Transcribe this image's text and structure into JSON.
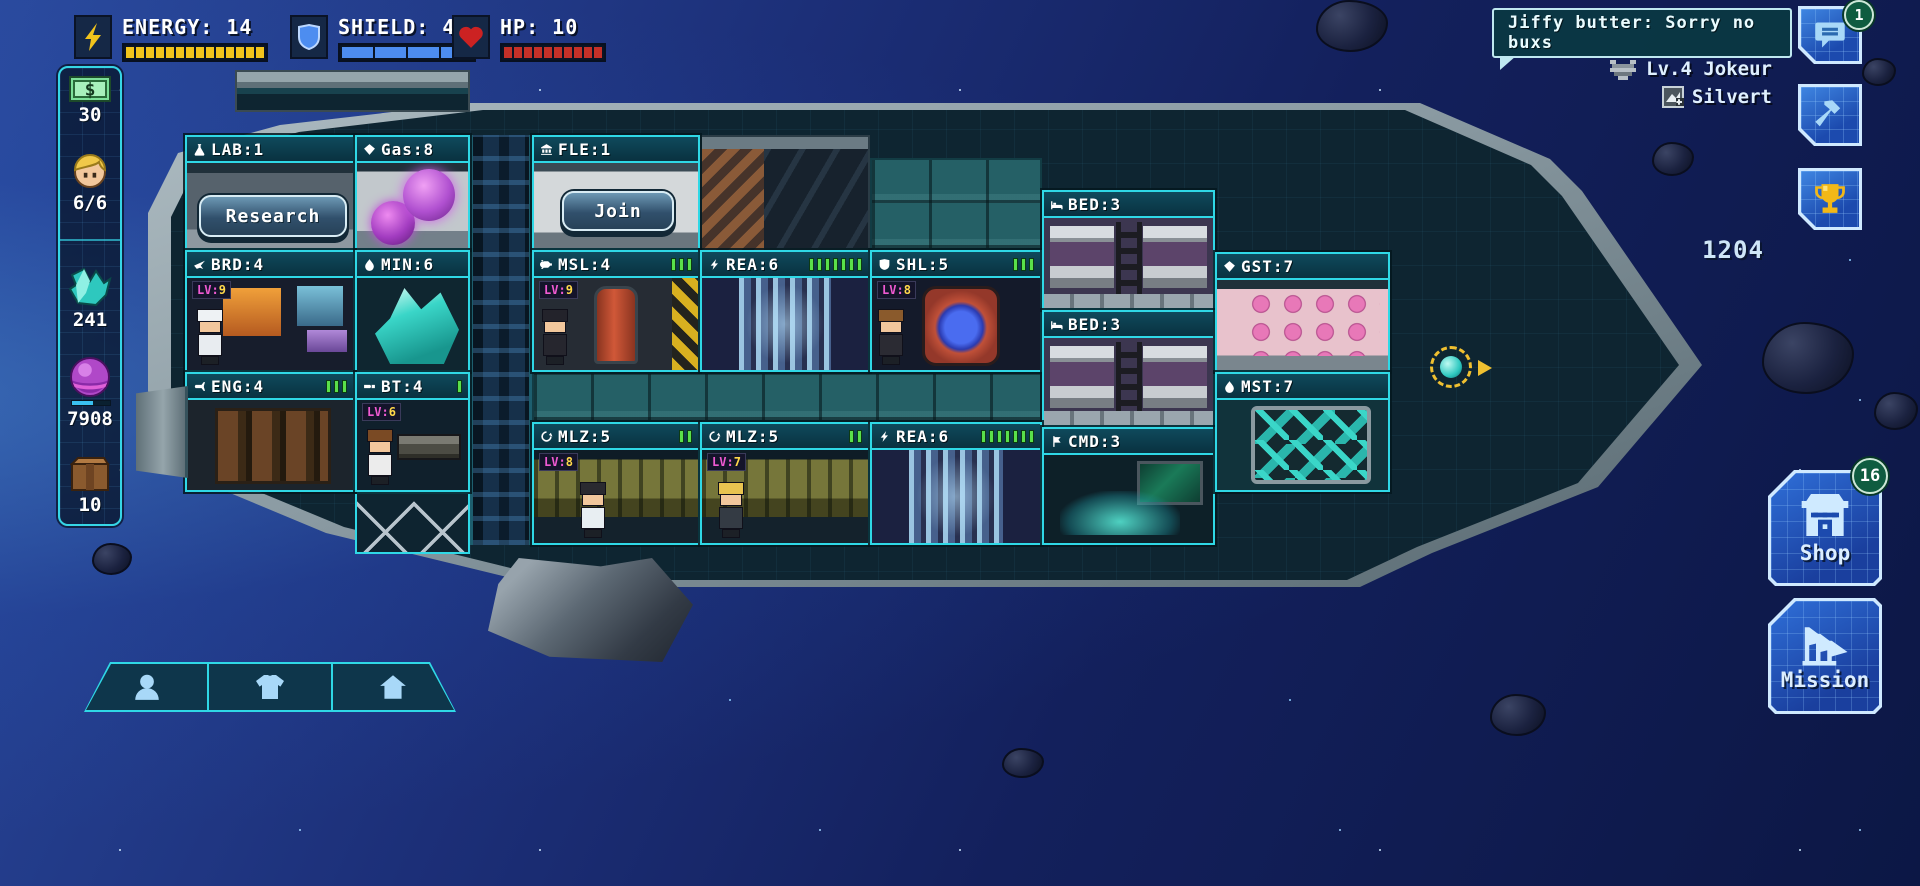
{
  "status_bar": {
    "energy_label": "ENERGY: 14",
    "energy_value": 14,
    "energy_max": 14,
    "shield_label": "SHIELD: 4",
    "shield_value": 4,
    "shield_max": 4,
    "hp_label": "HP: 10",
    "hp_value": 10,
    "hp_max": 10
  },
  "sidebar": {
    "items": [
      {
        "icon": "cash-icon",
        "value": "30"
      },
      {
        "icon": "crew-icon",
        "value": "6/6"
      },
      {
        "icon": "mineral-icon",
        "value": "241"
      },
      {
        "icon": "gas-orb-icon",
        "value": "7908"
      },
      {
        "icon": "crate-icon",
        "value": "10"
      }
    ]
  },
  "chat": {
    "message": "Jiffy butter: Sorry no buxs",
    "badge": "1"
  },
  "player": {
    "ship_level_name": "Lv.4 Jokeur",
    "captain_name": "Silvert"
  },
  "trophy": {
    "score": "1204"
  },
  "shop": {
    "label": "Shop",
    "badge": "16"
  },
  "mission": {
    "label": "Mission"
  },
  "ship": {
    "buttons": {
      "research": "Research",
      "join": "Join"
    },
    "rooms": [
      {
        "id": "lab",
        "label": "LAB:1",
        "icon": "flask-icon",
        "bars": 0
      },
      {
        "id": "gas",
        "label": "Gas:8",
        "icon": "gem-icon",
        "bars": 0
      },
      {
        "id": "fle",
        "label": "FLE:1",
        "icon": "bank-icon",
        "bars": 0
      },
      {
        "id": "brd",
        "label": "BRD:4",
        "icon": "plane-icon",
        "bars": 0,
        "lv": "LV:9"
      },
      {
        "id": "min",
        "label": "MIN:6",
        "icon": "droplet-icon",
        "bars": 0
      },
      {
        "id": "msl",
        "label": "MSL:4",
        "icon": "missile-icon",
        "bars": 3,
        "lv": "LV:9"
      },
      {
        "id": "rea1",
        "label": "REA:6",
        "icon": "bolt-icon",
        "bars": 7
      },
      {
        "id": "shl",
        "label": "SHL:5",
        "icon": "shield-icon",
        "bars": 3,
        "lv": "LV:8"
      },
      {
        "id": "bed1",
        "label": "BED:3",
        "icon": "bed-icon",
        "bars": 0
      },
      {
        "id": "bed2",
        "label": "BED:3",
        "icon": "bed-icon",
        "bars": 0
      },
      {
        "id": "gst",
        "label": "GST:7",
        "icon": "gem-icon",
        "bars": 0
      },
      {
        "id": "eng",
        "label": "ENG:4",
        "icon": "engine-icon",
        "bars": 3
      },
      {
        "id": "bt",
        "label": "BT:4",
        "icon": "bullet-icon",
        "bars": 1,
        "lv": "LV:6"
      },
      {
        "id": "mlz1",
        "label": "MLZ:5",
        "icon": "gear-icon",
        "bars": 2,
        "lv": "LV:8"
      },
      {
        "id": "mlz2",
        "label": "MLZ:5",
        "icon": "gear-icon",
        "bars": 2,
        "lv": "LV:7"
      },
      {
        "id": "rea2",
        "label": "REA:6",
        "icon": "bolt-icon",
        "bars": 7
      },
      {
        "id": "cmd",
        "label": "CMD:3",
        "icon": "flag-icon",
        "bars": 0
      },
      {
        "id": "mst",
        "label": "MST:7",
        "icon": "droplet-icon",
        "bars": 0
      }
    ]
  },
  "bottom_toolbar": {
    "items": [
      {
        "icon": "crew-bust-icon"
      },
      {
        "icon": "shirt-icon"
      },
      {
        "icon": "home-icon"
      }
    ]
  },
  "colors": {
    "accent_cyan": "#2fd8e6",
    "energy_yellow": "#f2c41c",
    "shield_blue": "#4d8df0",
    "hp_red": "#c43028",
    "bar_green": "#5ae04a",
    "badge_green": "#0f5c40",
    "button_blue": "#2a6ad0"
  }
}
